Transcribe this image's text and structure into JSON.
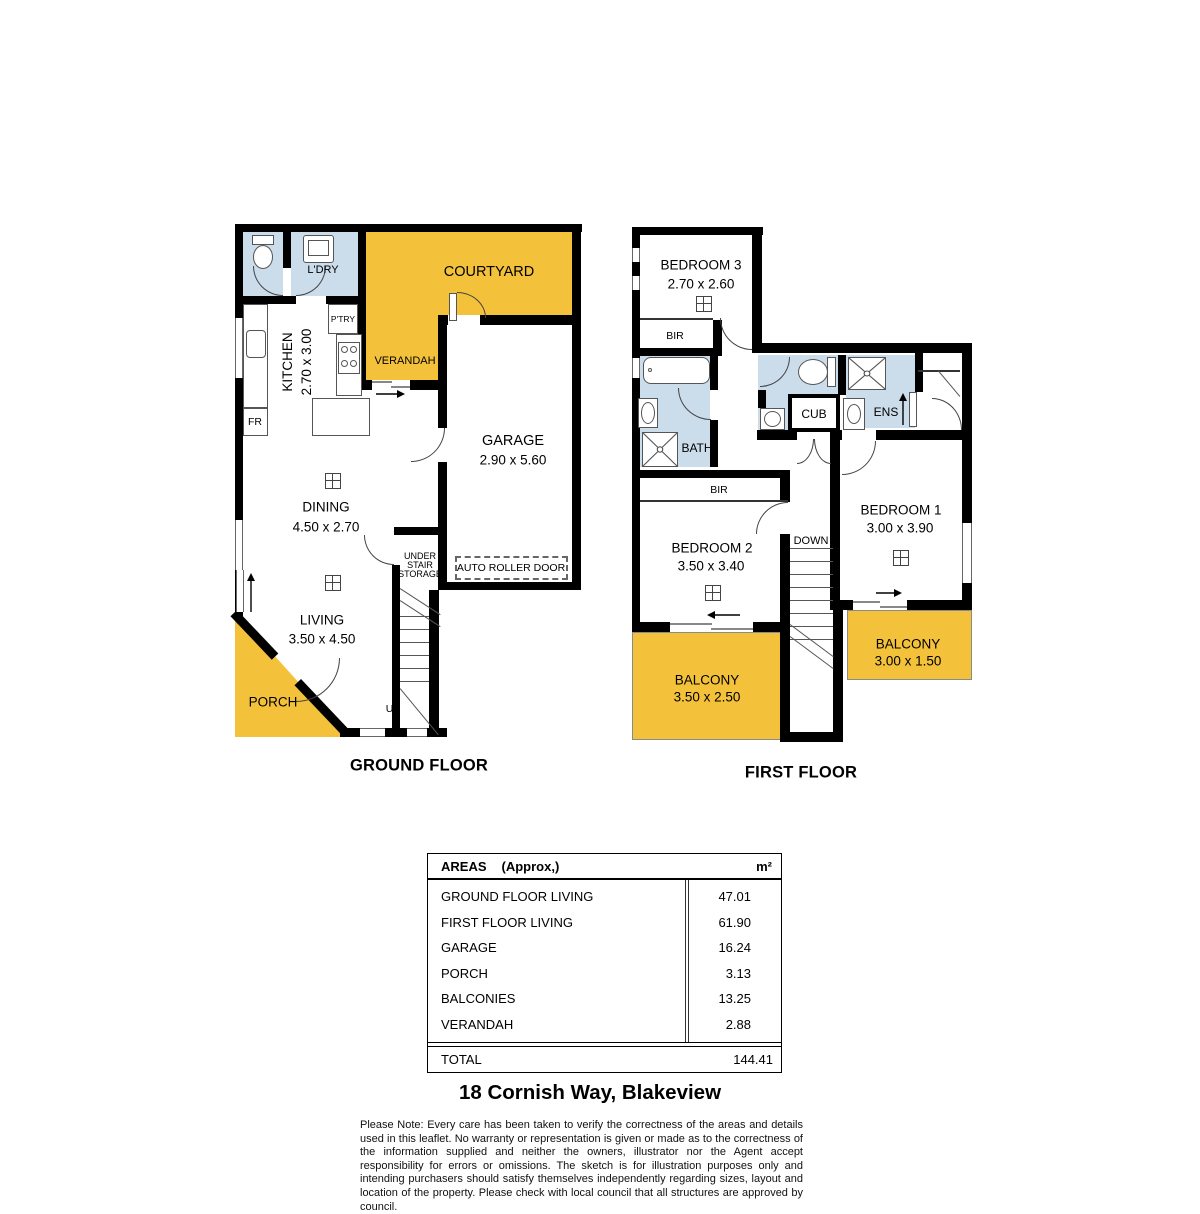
{
  "ground_floor": {
    "title": "GROUND FLOOR",
    "rooms": {
      "courtyard": {
        "label": "COURTYARD"
      },
      "verandah": {
        "label": "VERANDAH"
      },
      "laundry": {
        "label": "L'DRY"
      },
      "pantry": {
        "label": "P'TRY"
      },
      "kitchen": {
        "label": "KITCHEN",
        "dims": "2.70 x 3.00"
      },
      "fridge": {
        "label": "FR"
      },
      "garage": {
        "label": "GARAGE",
        "dims": "2.90 x 5.60"
      },
      "roller_door": {
        "label": "AUTO ROLLER DOOR"
      },
      "dining": {
        "label": "DINING",
        "dims": "4.50 x 2.70"
      },
      "living": {
        "label": "LIVING",
        "dims": "3.50 x 4.50"
      },
      "porch": {
        "label": "PORCH"
      },
      "under_stair": {
        "line1": "UNDER",
        "line2": "STAIR",
        "line3": "STORAGE"
      },
      "up": {
        "label": "UP"
      }
    }
  },
  "first_floor": {
    "title": "FIRST FLOOR",
    "rooms": {
      "bedroom3": {
        "label": "BEDROOM 3",
        "dims": "2.70 x 2.60"
      },
      "bir1": {
        "label": "BIR"
      },
      "bath": {
        "label": "BATH"
      },
      "cub": {
        "label": "CUB"
      },
      "ens": {
        "label": "ENS"
      },
      "bir2": {
        "label": "BIR"
      },
      "bedroom2": {
        "label": "BEDROOM 2",
        "dims": "3.50 x 3.40"
      },
      "bedroom1": {
        "label": "BEDROOM 1",
        "dims": "3.00 x 3.90"
      },
      "down": {
        "label": "DOWN"
      },
      "balcony_left": {
        "label": "BALCONY",
        "dims": "3.50 x 2.50"
      },
      "balcony_right": {
        "label": "BALCONY",
        "dims": "3.00 x 1.50"
      }
    }
  },
  "areas_table": {
    "title": "AREAS",
    "subtitle": "(Approx,)",
    "unit": "m²",
    "rows": [
      {
        "label": "GROUND FLOOR LIVING",
        "value": "47.01"
      },
      {
        "label": "FIRST FLOOR LIVING",
        "value": "61.90"
      },
      {
        "label": "GARAGE",
        "value": "16.24"
      },
      {
        "label": "PORCH",
        "value": "3.13"
      },
      {
        "label": "BALCONIES",
        "value": "13.25"
      },
      {
        "label": "VERANDAH",
        "value": "2.88"
      }
    ],
    "total": {
      "label": "TOTAL",
      "value": "144.41"
    }
  },
  "address": "18 Cornish Way, Blakeview",
  "disclaimer": "Please Note: Every care has been taken to verify the correctness of the areas and details used in this leaflet. No warranty or representation is given or made as to the correctness of the information supplied and neither the owners, illustrator nor the Agent accept responsibility for errors or omissions. The sketch is for illustration purposes only and intending purchasers should satisfy themselves independently regarding sizes, layout and location of the property. Please check with local council that all structures are approved by council.",
  "colors": {
    "outdoor_yellow": "#F3C23A",
    "wet_area_blue": "#CBDCEB",
    "wall_black": "#000000"
  }
}
